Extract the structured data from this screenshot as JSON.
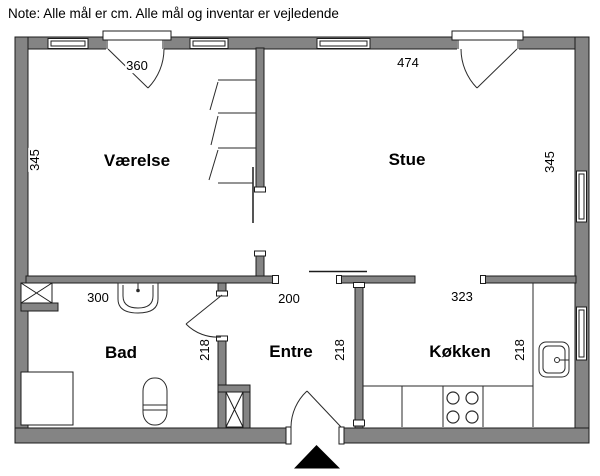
{
  "note": "Note: Alle mål er cm. Alle mål og inventar er vejledende",
  "rooms": {
    "vaerelse": {
      "label": "Værelse",
      "width_cm": "360",
      "depth_cm": "345"
    },
    "stue": {
      "label": "Stue",
      "width_cm": "474",
      "depth_cm": "345"
    },
    "bad": {
      "label": "Bad",
      "width_cm": "300",
      "depth_cm": "218"
    },
    "entre": {
      "label": "Entre",
      "width_cm": "200",
      "depth_cm": "218"
    },
    "koekken": {
      "label": "Køkken",
      "width_cm": "323",
      "depth_cm": "218"
    }
  },
  "units": "cm",
  "fixtures": [
    "ventilation-shaft",
    "washbasin",
    "toilet",
    "shower",
    "wardrobe",
    "kitchen-counter",
    "stove",
    "kitchen-sink",
    "entrance-arrow"
  ],
  "colors": {
    "wall_fill": "#848484",
    "outline": "#1c1c1c",
    "entrance_marker": "#000000",
    "background": "#ffffff"
  }
}
